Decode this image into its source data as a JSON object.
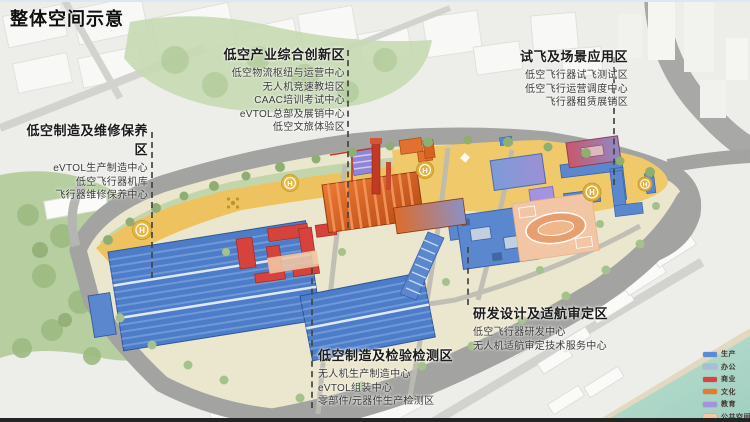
{
  "page": {
    "title": "整体空间示意"
  },
  "zones": [
    {
      "id": "innovation",
      "title": "低空产业综合创新区",
      "items": [
        "低空物流枢纽与运营中心",
        "无人机竞速教培区",
        "CAAC培训考试中心",
        "eVTOL总部及展销中心",
        "低空文旅体验区"
      ]
    },
    {
      "id": "flight-test",
      "title": "试飞及场景应用区",
      "items": [
        "低空飞行器试飞测试区",
        "低空飞行运营调度中心",
        "飞行器租赁展销区"
      ]
    },
    {
      "id": "maintenance",
      "title": "低空制造及维修保养区",
      "items": [
        "eVTOL生产制造中心",
        "低空飞行器机库",
        "飞行器维修保养中心"
      ]
    },
    {
      "id": "inspection",
      "title": "低空制造及检验检测区",
      "items": [
        "无人机生产制造中心",
        "eVTOL组装中心",
        "零部件/元器件生产检测区"
      ]
    },
    {
      "id": "rd",
      "title": "研发设计及适航审定区",
      "items": [
        "低空飞行器研发中心",
        "无人机适航审定技术服务中心"
      ]
    }
  ],
  "legend": {
    "items": [
      {
        "label": "生产",
        "color": "#5b8bd4"
      },
      {
        "label": "办公",
        "color": "#a8bed8"
      },
      {
        "label": "商业",
        "color": "#e04040"
      },
      {
        "label": "文化",
        "color": "#f07820"
      },
      {
        "label": "教育",
        "color": "#a293dc"
      },
      {
        "label": "公共空间",
        "color": "#f4c9a4"
      }
    ]
  },
  "map": {
    "helipad_letter": "H"
  }
}
